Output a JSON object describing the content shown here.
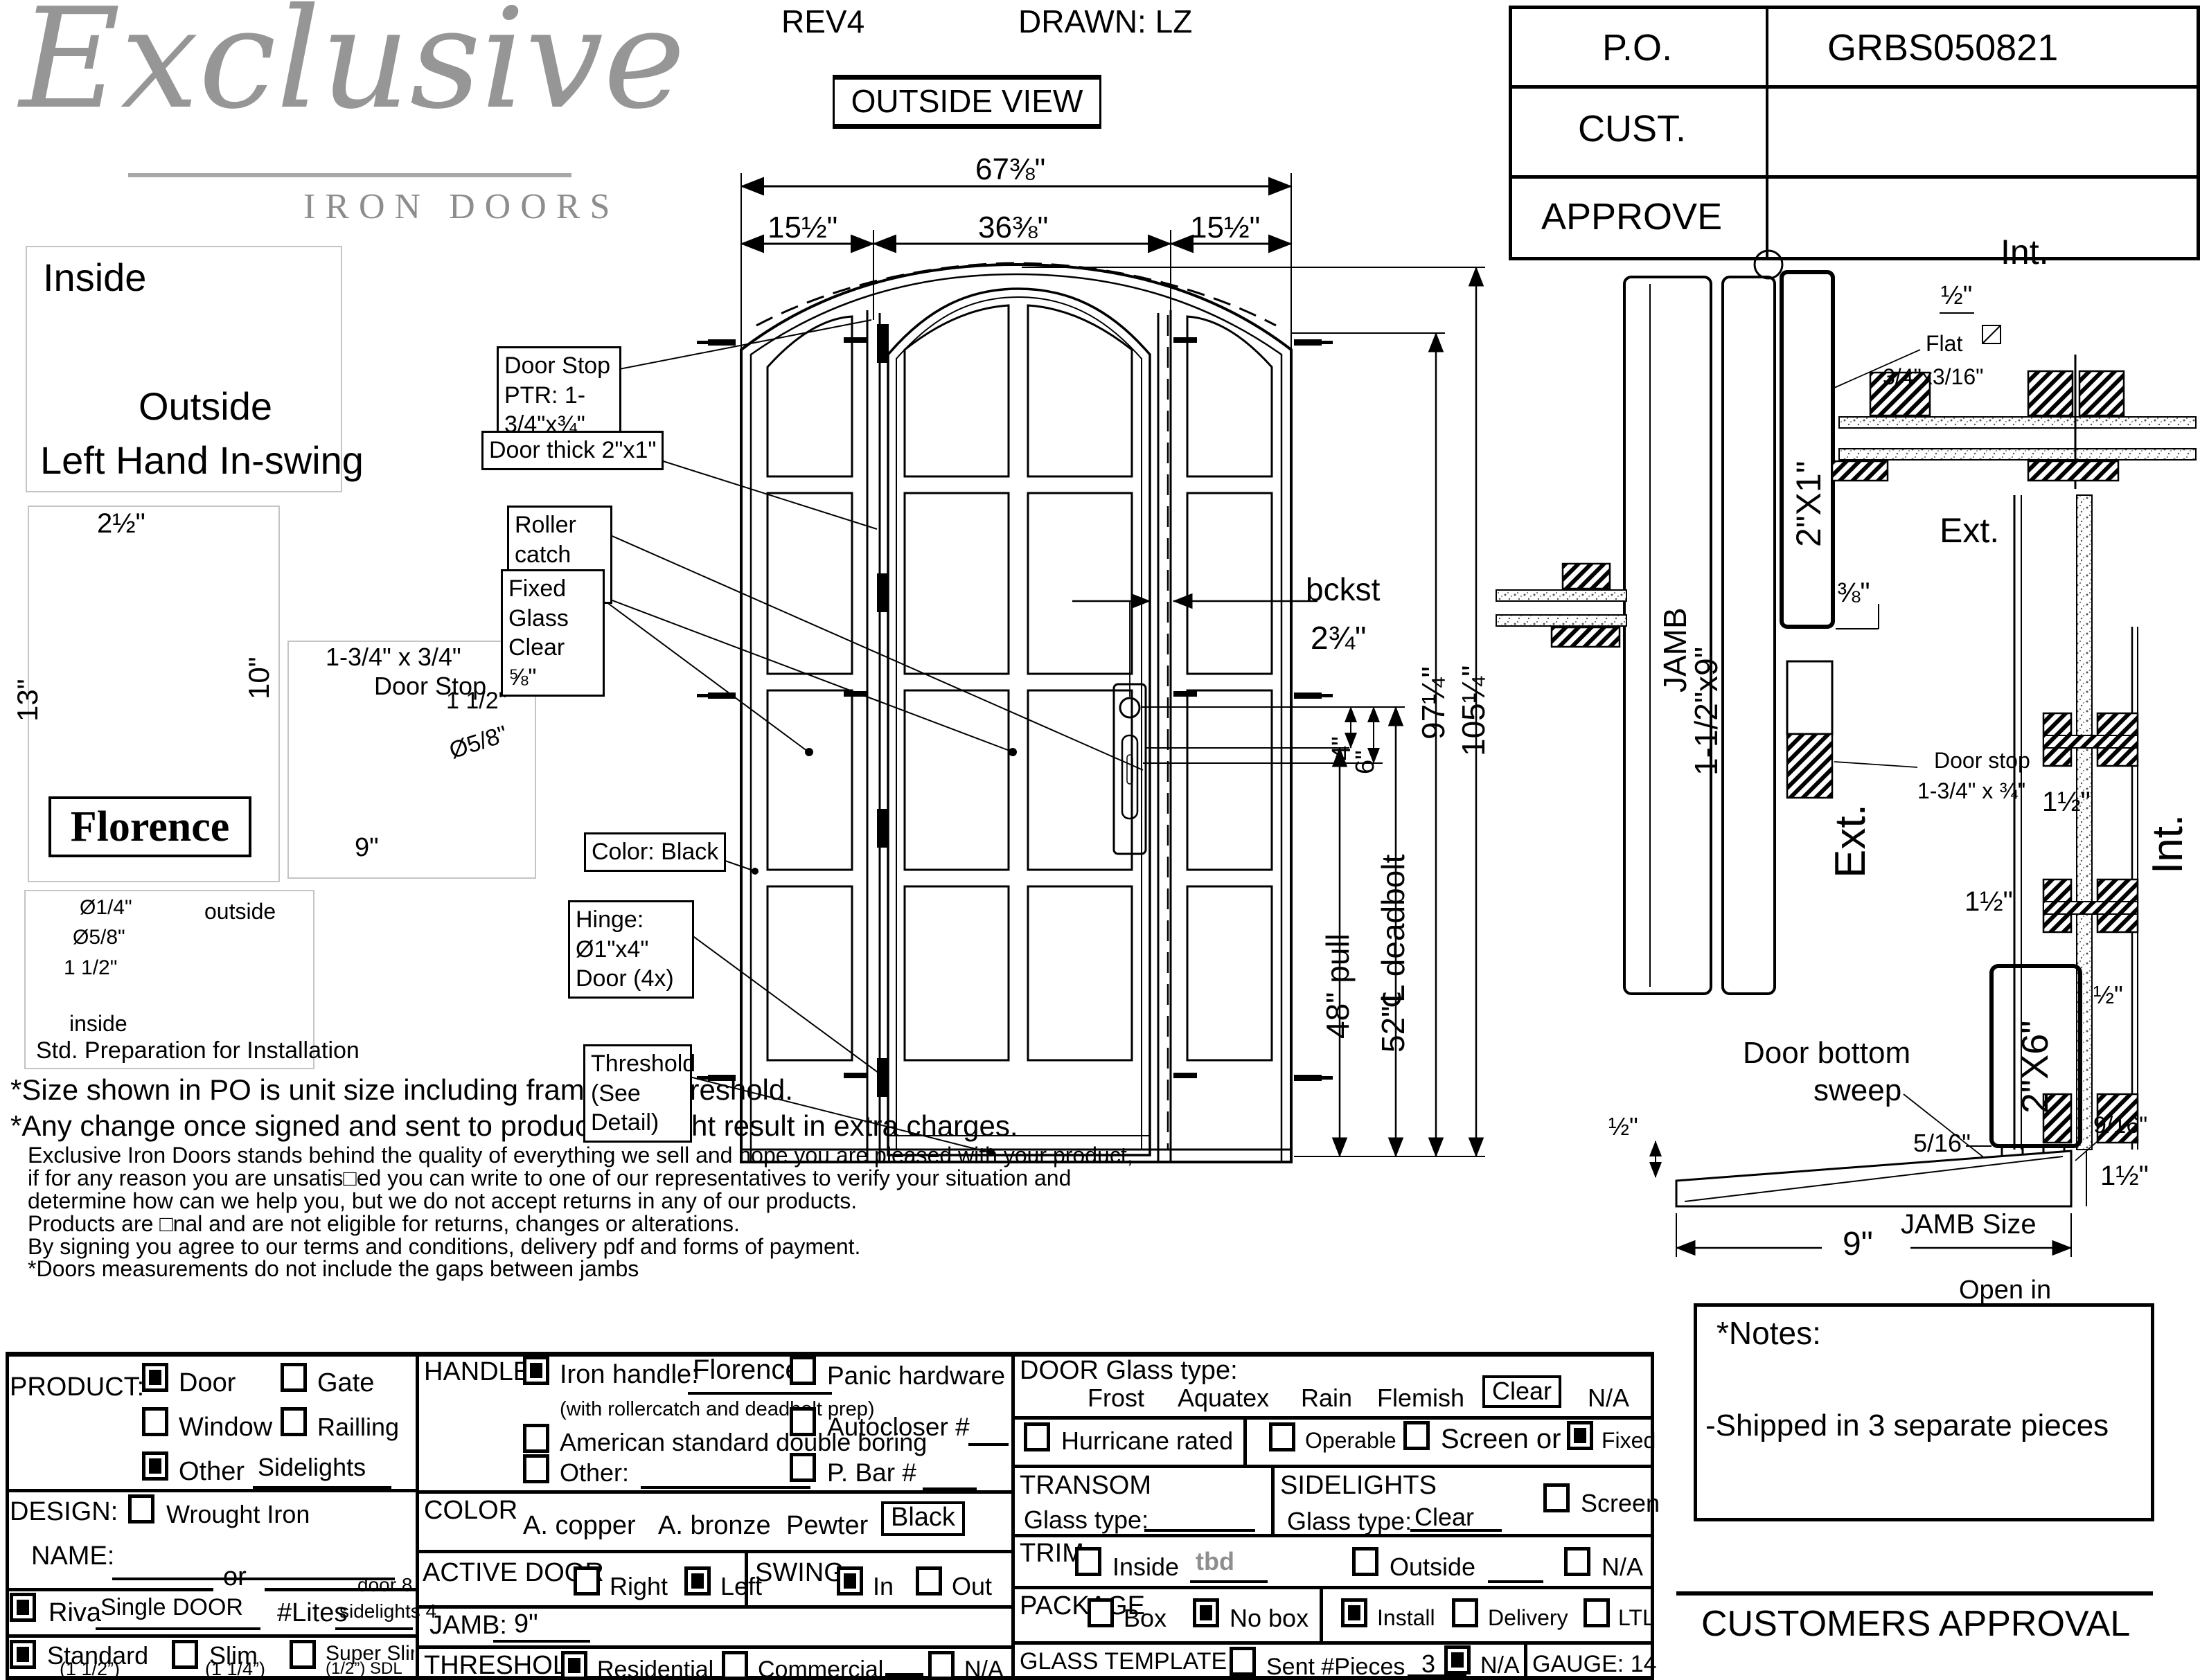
{
  "logo": {
    "script": "Exclusive",
    "sub": "IRON DOORS"
  },
  "header": {
    "rev": "REV4",
    "drawn": "DRAWN: LZ",
    "view": "OUTSIDE VIEW"
  },
  "po": {
    "label": "P.O.",
    "value": "GRBS050821",
    "cust": "CUST.",
    "approve": "APPROVE"
  },
  "swing": {
    "inside": "Inside",
    "outside": "Outside",
    "caption": "Left Hand In-swing"
  },
  "florence": {
    "w": "2½\"",
    "h": "13\"",
    "bar": "10\"",
    "name": "Florence"
  },
  "stop_detail": {
    "l1": "1-3/4\" x 3/4\"",
    "l2": "Door Stop",
    "d1": "1 1/2\"",
    "d2": "Ø5/8\"",
    "d3": "9\""
  },
  "prep": {
    "d1": "Ø1/4\"",
    "d2": "Ø5/8\"",
    "d3": "1 1/2\"",
    "outside": "outside",
    "inside": "inside",
    "caption": "Std. Preparation for Installation"
  },
  "disclaimers": {
    "s1": "*Size shown in PO is unit size including frame and threshold.",
    "s2": "*Any change once signed and sent to production might result in extra charges.",
    "p1": "Exclusive Iron Doors stands behind the quality of everything we sell and hope you are pleased with your product,",
    "p2": "if for any reason you are unsatis□ed you can write to one of our representatives to verify your situation and",
    "p3": "determine how can we help you, but we do not accept returns in any of our products.",
    "p4": "Products are □nal and are not eligible for returns, changes or alterations.",
    "p5": "By signing you agree to our terms and conditions, delivery pdf and forms of payment.",
    "p6": "*Doors measurements do not include the gaps between jambs"
  },
  "dims": {
    "total": "67⅜\"",
    "left": "15½\"",
    "mid": "36⅜\"",
    "right": "15½\"",
    "bckst": "bckst",
    "bckst_v": "2¾\"",
    "four": "4\"",
    "six": "6\"",
    "pull": "48\" pull",
    "deadbolt": "52\"℄ deadbolt",
    "h97": "97¼\"",
    "h105": "105¼\""
  },
  "callouts": {
    "c1a": "Door Stop",
    "c1b": "PTR: 1-3/4\"x¾\"",
    "c2": "Door thick 2\"x1\"",
    "c3a": "Roller catch",
    "c3b": "(1x)",
    "c4a": "Fixed Glass",
    "c4b": "Clear ⅝\"",
    "c5": "Color: Black",
    "c6a": "Hinge: Ø1\"x4\"",
    "c6b": "Door (4x)",
    "c7a": "Threshold",
    "c7b": "(See Detail)"
  },
  "head_section": {
    "jamb1": "JAMB",
    "jamb2": "1-1/2\"x9\"",
    "tube": "2\"X1\"",
    "int_label": "Int.",
    "ext_label": "Ext.",
    "half": "½\"",
    "flat1": "Flat",
    "flat2": "3/4\"x3/16\"",
    "threeeighths": "⅜\"",
    "ds1": "Door stop",
    "ds2": "1-3/4\" x ¾\""
  },
  "vsection": {
    "ext_label": "Ext.",
    "int_label": "Int.",
    "dim_a": "1½\"",
    "dim_b": "1½\"",
    "half": "½\"",
    "s516": "5/16\"",
    "tube": "2\"X6\"",
    "sweep1": "Door bottom",
    "sweep2": "sweep",
    "s916": "9/16\"",
    "half2": "½\"",
    "dim_c": "1½\"",
    "jamb_size": "JAMB Size",
    "nine": "9\"",
    "open_in": "Open in"
  },
  "notes": {
    "title": "*Notes:",
    "line1": "-Shipped in 3 separate pieces"
  },
  "approval": "CUSTOMERS APPROVAL",
  "form": {
    "product": {
      "label": "PRODUCT:",
      "door": "Door",
      "gate": "Gate",
      "window": "Window",
      "railing": "Railling",
      "other": "Other",
      "other_value": "Sidelights"
    },
    "design": {
      "label": "DESIGN:",
      "wrought": "Wrought Iron",
      "name_label": "NAME:",
      "or": "or",
      "riva": "Riva",
      "riva_value": "Single DOOR",
      "lites": "#Lites",
      "lites_top": "door 8",
      "lites_val": "sidelights 4",
      "standard": "Standard",
      "standard_sub": "(1 1/2”)",
      "slim": "Slim",
      "slim_sub": "(1 1/4”)",
      "superslim": "Super Slim",
      "superslim_sub": "(1/2”) SDL"
    },
    "handle": {
      "label": "HANDLE",
      "iron": "Iron handle:",
      "iron_value": "Florence",
      "iron_sub": "(with rollercatch and deadbolt prep)",
      "american": "American standard double boring",
      "other": "Other:",
      "panic": "Panic hardware",
      "autocloser": "Autocloser #",
      "pbar": "P. Bar #"
    },
    "color": {
      "label": "COLOR",
      "c1": "A. copper",
      "c2": "A. bronze",
      "c3": "Pewter",
      "c4": "Black"
    },
    "active": {
      "label": "ACTIVE DOOR",
      "right": "Right",
      "left": "Left"
    },
    "swing": {
      "label": "SWING",
      "in": "In",
      "out": "Out"
    },
    "jamb": {
      "label": "JAMB:",
      "value": "9\""
    },
    "threshold": {
      "label": "THRESHOLD",
      "residential": "Residential",
      "commercial": "Commercial",
      "na": "N/A"
    },
    "glass": {
      "label": "DOOR Glass type:",
      "frost": "Frost",
      "aquatex": "Aquatex",
      "rain": "Rain",
      "flemish": "Flemish",
      "clear": "Clear",
      "na": "N/A"
    },
    "hurricane": "Hurricane rated",
    "operable": "Operable",
    "screen_or": "Screen or",
    "fixed": "Fixed",
    "transom": {
      "label": "TRANSOM",
      "glass_type": "Glass type:"
    },
    "sidelights": {
      "label": "SIDELIGHTS",
      "glass_type": "Glass type:",
      "value": "Clear",
      "screen": "Screen"
    },
    "trim": {
      "label": "TRIM",
      "inside": "Inside",
      "inside_value": "tbd",
      "outside": "Outside",
      "na": "N/A"
    },
    "package": {
      "label": "PACKAGE",
      "box": "Box",
      "nobox": "No box",
      "install": "Install",
      "delivery": "Delivery",
      "ltl": "LTL"
    },
    "glass_template": {
      "label": "GLASS TEMPLATE",
      "sent": "Sent #Pieces",
      "pieces": "3",
      "na": "N/A"
    },
    "gauge": "GAUGE: 14",
    "checks": {
      "product_door": true,
      "product_gate": false,
      "product_window": false,
      "product_railing": false,
      "product_other": true,
      "design_wrought": false,
      "riva": true,
      "standard": true,
      "slim": false,
      "superslim": false,
      "handle_iron": true,
      "handle_american": false,
      "handle_other": false,
      "panic": false,
      "autocloser": false,
      "pbar": false,
      "active_right": false,
      "active_left": true,
      "swing_in": true,
      "swing_out": false,
      "threshold_residential": true,
      "threshold_commercial": false,
      "threshold_na": false,
      "hurricane": false,
      "operable": false,
      "screen_or": false,
      "fixed": true,
      "sidelights_screen": false,
      "trim_inside": false,
      "trim_outside": false,
      "trim_na": false,
      "package_box": false,
      "package_nobox": true,
      "install": true,
      "delivery": false,
      "ltl": false,
      "glass_sent": false,
      "glass_na": true
    }
  }
}
